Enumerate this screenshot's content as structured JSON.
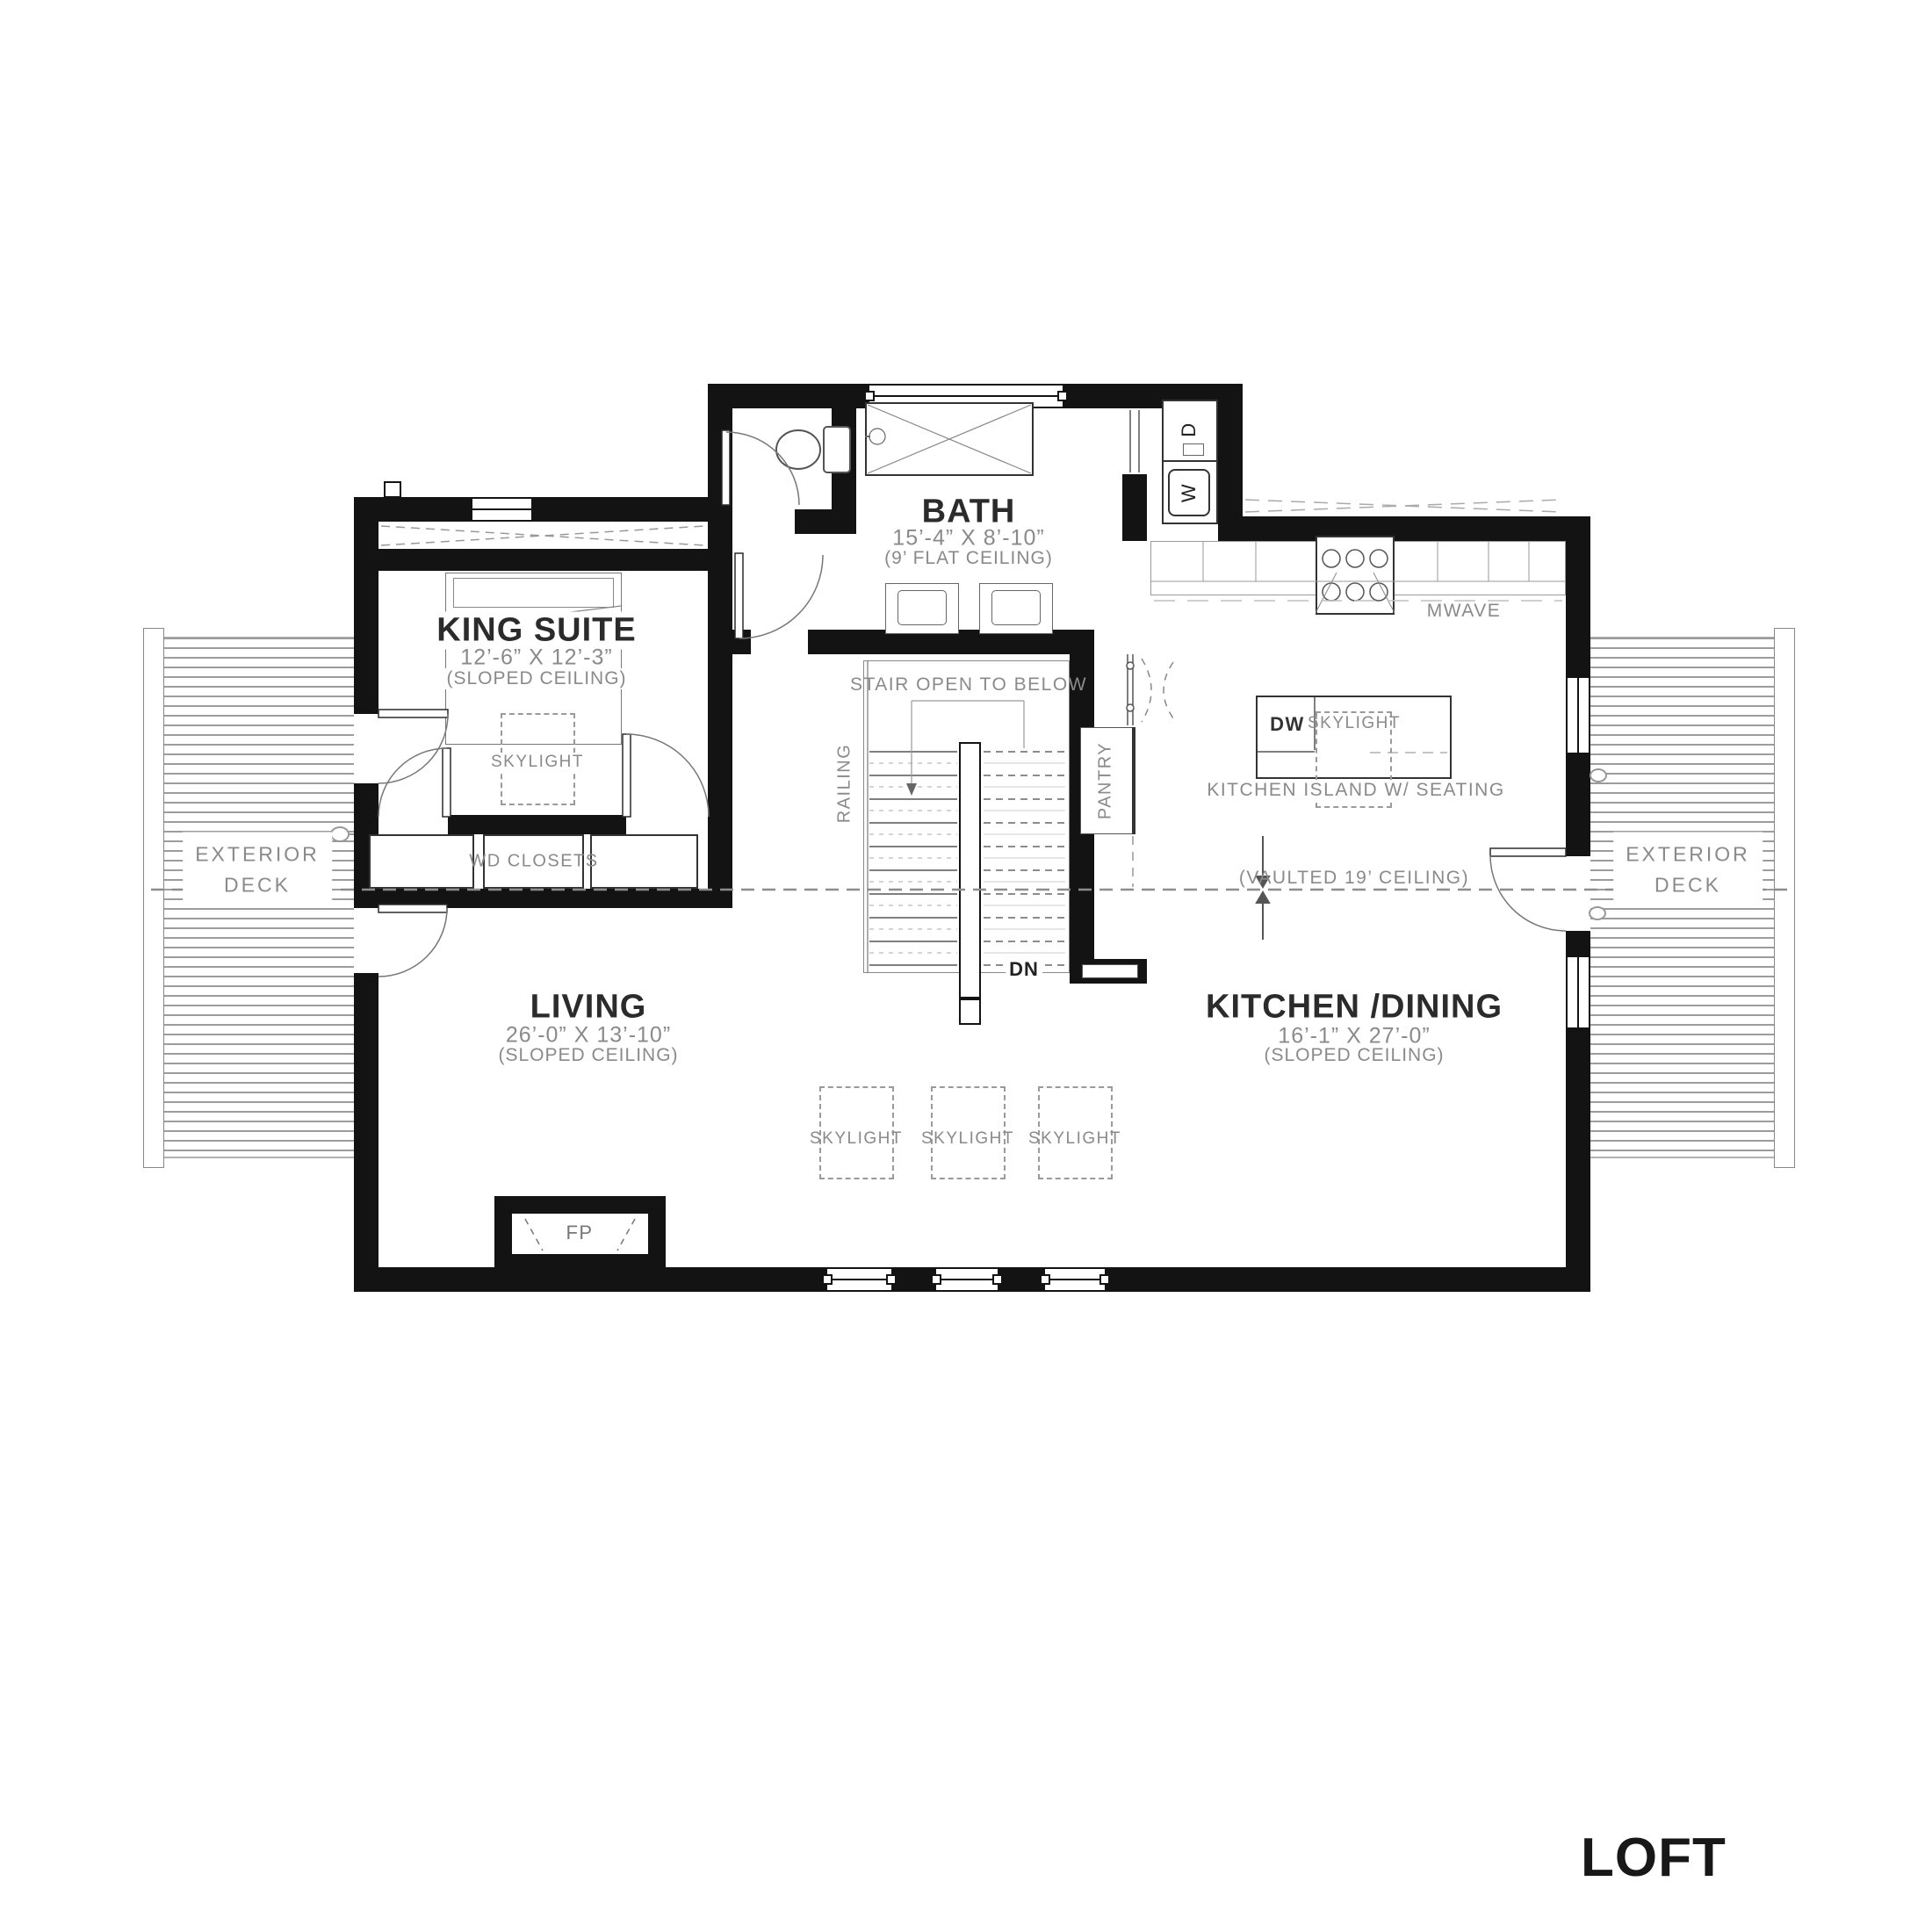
{
  "page_title": "LOFT",
  "rooms": {
    "king_suite": {
      "name": "KING SUITE",
      "dims": "12’-6” X 12’-3”",
      "ceiling": "(SLOPED CEILING)"
    },
    "bath": {
      "name": "BATH",
      "dims": "15’-4” X 8’-10”",
      "ceiling": "(9’ FLAT CEILING)"
    },
    "living": {
      "name": "LIVING",
      "dims": "26’-0” X 13’-10”",
      "ceiling": "(SLOPED CEILING)"
    },
    "kitchen_dining": {
      "name": "KITCHEN /DINING",
      "dims": "16’-1” X 27’-0”",
      "ceiling": "(SLOPED CEILING)"
    }
  },
  "labels": {
    "skylight": "SKYLIGHT",
    "wd_closets": "WD CLOSETS",
    "exterior_deck_line1": "EXTERIOR",
    "exterior_deck_line2": "DECK",
    "stair_open_to_below": "STAIR OPEN TO BELOW",
    "railing": "RAILING",
    "pantry": "PANTRY",
    "down": "DN",
    "mwave": "MWAVE",
    "dishwasher": "DW",
    "fireplace": "FP",
    "washer": "W",
    "dryer": "D",
    "kitchen_island": "KITCHEN ISLAND W/ SEATING",
    "vaulted_ceiling": "(VAULTED 19’ CEILING)"
  },
  "colors": {
    "wall": "#131313",
    "label_gray": "#8a8a8a",
    "title_dark": "#2b2b2b",
    "line": "#555555"
  }
}
